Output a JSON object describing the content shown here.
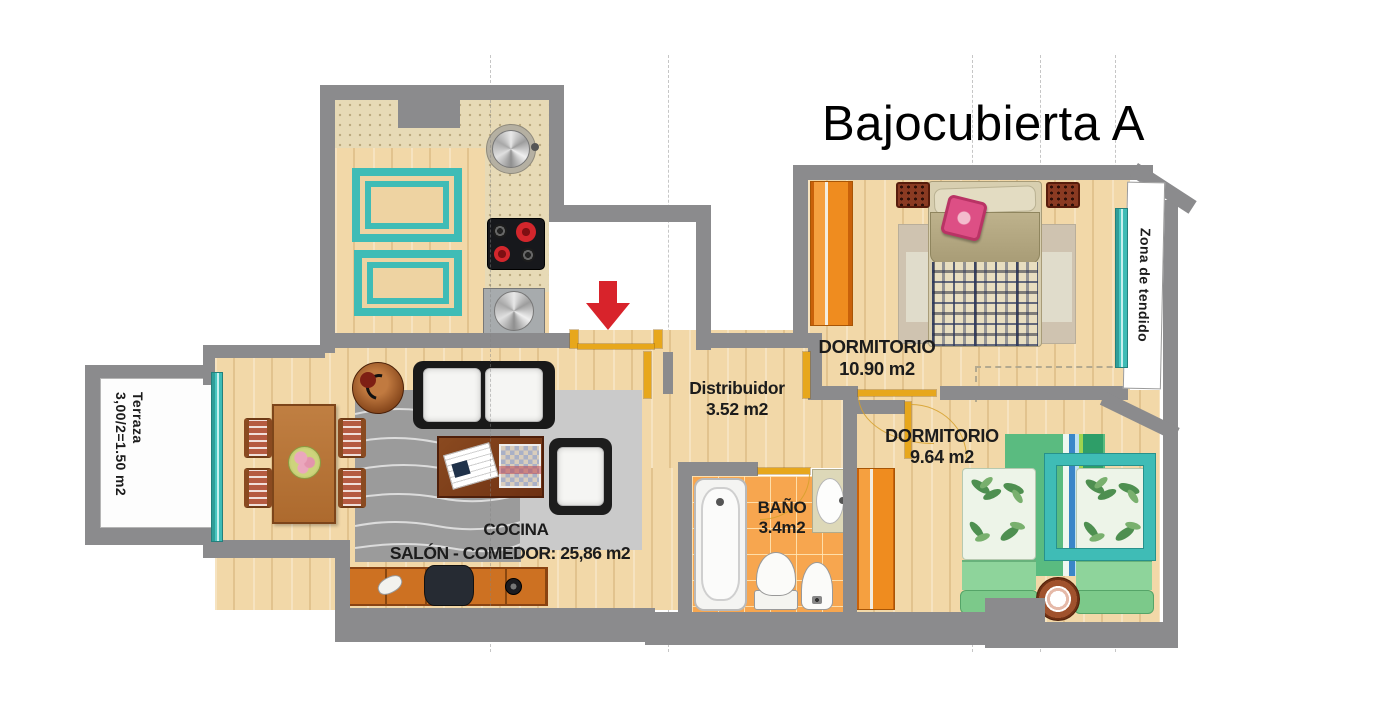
{
  "title": "Bajocubierta A",
  "rooms": {
    "cocina": {
      "name": "COCINA"
    },
    "salon": {
      "name": "SALÓN - COMEDOR: 25,86  m2"
    },
    "distribuidor": {
      "name": "Distribuidor",
      "area": "3.52 m2"
    },
    "dormitorio1": {
      "name": "DORMITORIO",
      "area": "10.90 m2"
    },
    "dormitorio2": {
      "name": "DORMITORIO",
      "area": "9.64 m2"
    },
    "bano": {
      "name": "BAÑO",
      "area": "3.4m2"
    },
    "terraza": {
      "name": "Terraza",
      "area": "3,00/2=1.50  m2"
    },
    "zona_tendido": {
      "name": "Zona de tendido"
    }
  },
  "colors": {
    "wall": "#8b8b8d",
    "wood_floor": "#f2d8a8",
    "bath_tile": "#f7a64f",
    "teal": "#3fbcb6",
    "wardrobe_orange": "#e87d12",
    "door_gold": "#e7a71c",
    "entrance_arrow_red": "#d8232b"
  }
}
